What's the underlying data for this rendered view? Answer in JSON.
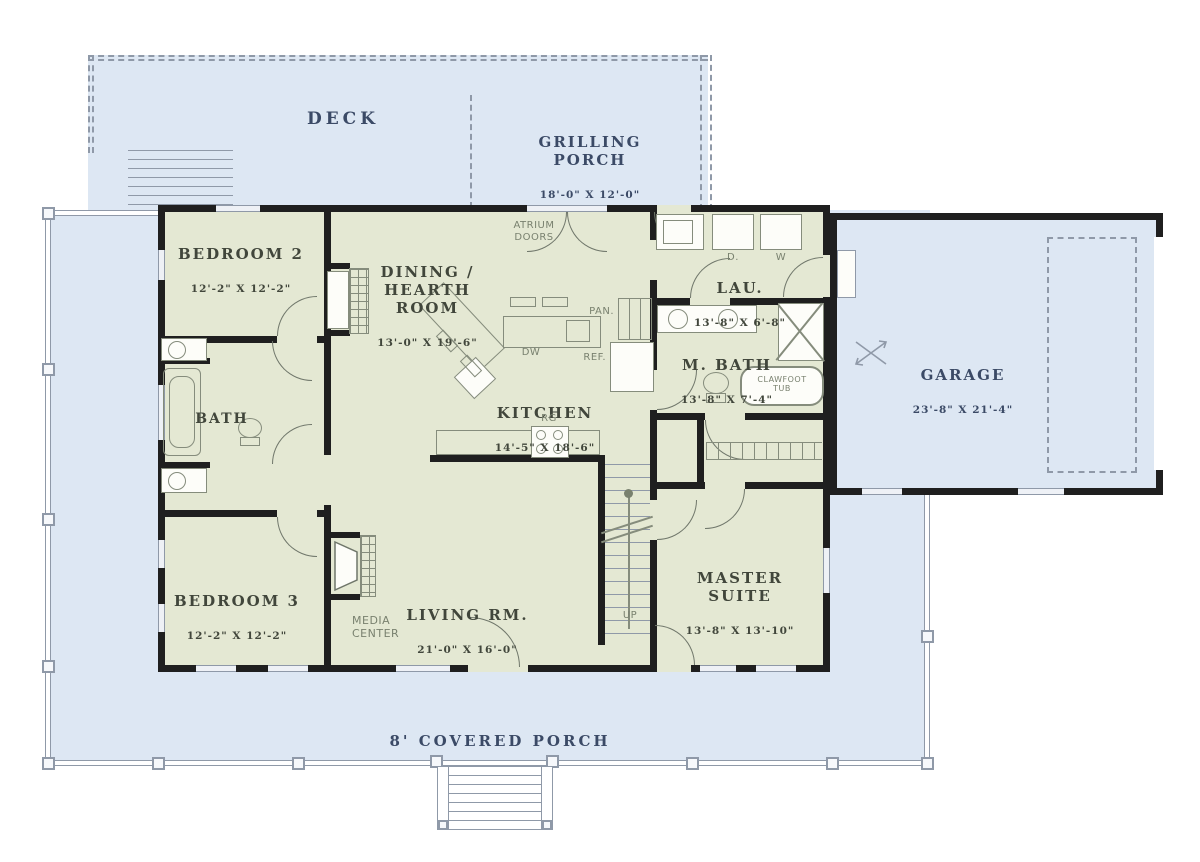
{
  "colors": {
    "porch_fill": "#dde7f3",
    "room_fill": "#e4e8d3",
    "wall": "#1f1f1f",
    "porch_line": "#8f99a8",
    "fixture_line": "#858c7c",
    "porch_text": "#3b4a66",
    "room_text": "#41463b",
    "fixture_text": "#79816f"
  },
  "areas": {
    "deck": {
      "name": "DECK"
    },
    "grilling_porch": {
      "name": "GRILLING\nPORCH",
      "dims": "18'-0\" X 12'-0\""
    },
    "covered_porch": {
      "name": "8' COVERED PORCH"
    },
    "garage": {
      "name": "GARAGE",
      "dims": "23'-8\" X 21'-4\""
    },
    "bedroom2": {
      "name": "BEDROOM 2",
      "dims": "12'-2\" X 12'-2\""
    },
    "bedroom3": {
      "name": "BEDROOM 3",
      "dims": "12'-2\" X 12'-2\""
    },
    "dining": {
      "name": "DINING /\nHEARTH ROOM",
      "dims": "13'-0\" X 19'-6\""
    },
    "kitchen": {
      "name": "KITCHEN",
      "dims": "14'-5\" X 18'-6\""
    },
    "living": {
      "name": "LIVING RM.",
      "dims": "21'-0\" X 16'-0\""
    },
    "laundry": {
      "name": "LAU.",
      "dims": "13'-8\" X 6'-8\""
    },
    "master_bath": {
      "name": "M. BATH",
      "dims": "13'-8\" X 7'-4\""
    },
    "master_suite": {
      "name": "MASTER\nSUITE",
      "dims": "13'-8\" X 13'-10\""
    },
    "bath": {
      "name": "BATH"
    }
  },
  "fixtures": {
    "atrium_doors": "ATRIUM\nDOORS",
    "pantry": "PAN.",
    "refrigerator": "REF.",
    "dishwasher": "DW",
    "range": "RG",
    "dryer": "D.",
    "washer": "W",
    "clawfoot_tub": "CLAWFOOT\nTUB",
    "media_center": "MEDIA\nCENTER",
    "stairs_up": "UP"
  }
}
